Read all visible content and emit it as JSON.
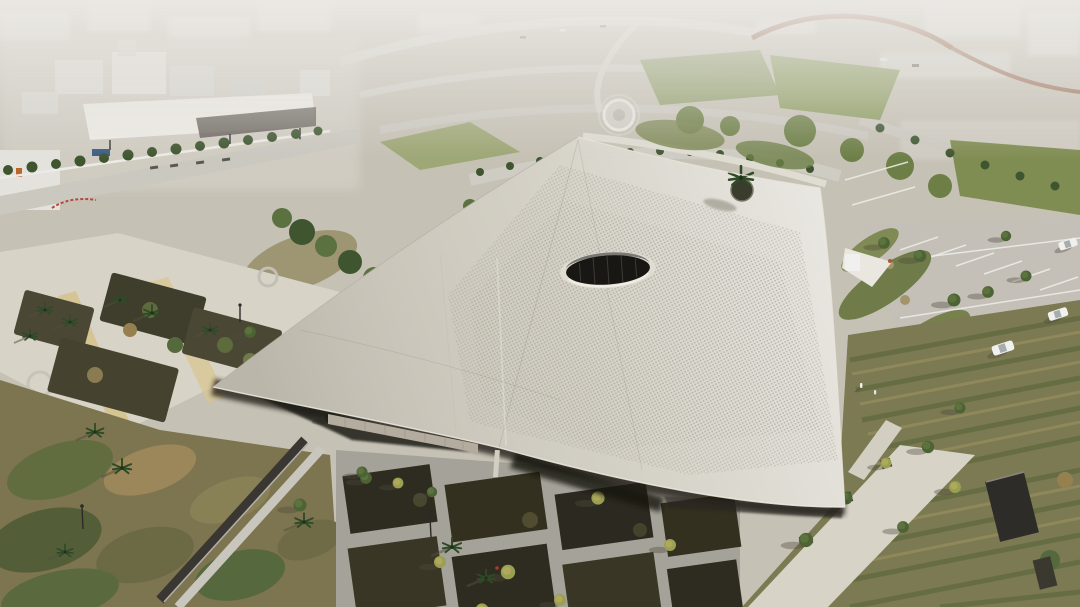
{
  "meta": {
    "title": "Aerial drone photograph of a desert cultural building with a vast sweeping perforated roof",
    "domain": "natural-image",
    "lighting": "late-afternoon sun from the upper right, long shadows cast to the lower left, hazy horizon at top"
  },
  "palette": {
    "ground": "#c6c1b5",
    "haze": "#e7e5e0",
    "roof": "#cfcbbf",
    "roofLit": "#dcd8cb",
    "perforation": "#a3a094",
    "oculus": "#181714",
    "oculusRim": "#dfdcd2",
    "eaveShadow": "#241f18",
    "facade": "#b4ac9e",
    "pathLight": "#d7d3c7",
    "pathYellow": "#d6c28b",
    "road": "#cbc8c0",
    "asphalt": "#c4c0b8",
    "laneWhite": "#eeede7",
    "lawn": "#84955b",
    "treeDark": "#3f5530",
    "treeLime": "#a89b54",
    "gardenBed": "#4a4734",
    "gardenDark": "#2e2b21",
    "gardenDry": "#91805a",
    "corten": "#8e5339",
    "white": "#eceae2",
    "kiosk": "#2d2c28",
    "carWhite": "#f0f1ee",
    "signBlue": "#3e5c86",
    "signOrange": "#c0652a",
    "accentRed": "#a43b2e"
  },
  "scene": {
    "building": {
      "roof": "angular swept roof plane, smooth pale concrete edges with dotted perforation field in the centre",
      "oculus": "dark elliptical skylight with pale rim and glazing mullions, near roof centre",
      "roof_palm": "single palm tree emerging through a circular opening on the right roof wing",
      "eave": "deep shadow under the floating eave with stone facade band and slender column"
    },
    "grounds": {
      "left_plaza": "cream paved plaza with sandy-yellow paths, planting beds and palms",
      "bottom_gardens": "grid of dark planted beds separated by concrete walkways, lime-green young trees",
      "slat_wall": "dark louvred wall running diagonally in the lower-left wild garden",
      "right_gardens": "nursery rows, green berms, pedestrian walkway with planter trees and dark kiosk",
      "parking": "light asphalt car park with angled white stall lines, a white SUV and white van"
    },
    "distance": {
      "industrial_zone": "hazy white industrial buildings and a large flat fuel-station canopy, tree-lined road",
      "highways": "sweeping interchange ramps, corten-red barrier wall, lawns, roundabout and palm-lined avenues",
      "skyline": "washed-out low-rise skyline in atmospheric haze"
    }
  }
}
